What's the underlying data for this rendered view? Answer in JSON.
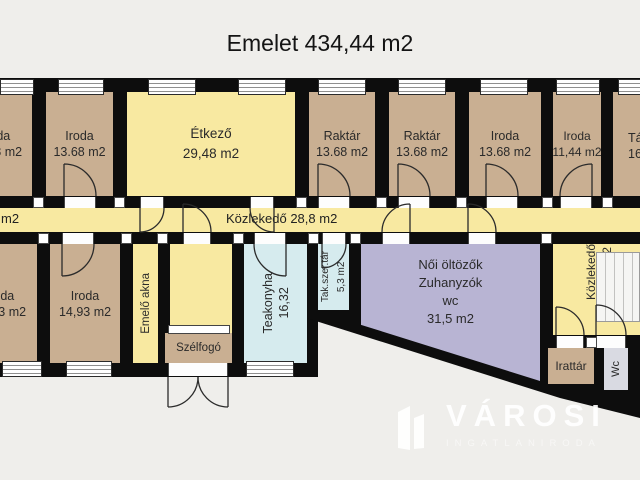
{
  "title": "Emelet 434,44 m2",
  "corridor": {
    "label": "Közlekedő 28,8 m2",
    "left_fragment": "m2"
  },
  "rooms": {
    "iroda_cut_top": {
      "name": "Iroda",
      "area": "13.68 m2"
    },
    "iroda2": {
      "name": "Iroda",
      "area": "13.68 m2"
    },
    "etkezo": {
      "name": "Étkező",
      "area": "29,48 m2"
    },
    "raktar1": {
      "name": "Raktár",
      "area": "13.68 m2"
    },
    "raktar2": {
      "name": "Raktár",
      "area": "13.68 m2"
    },
    "iroda3": {
      "name": "Iroda",
      "area": "13.68 m2"
    },
    "iroda4": {
      "name": "Iroda",
      "area": "11,44 m2"
    },
    "cut_right": {
      "name": "Tá",
      "area": "16"
    },
    "iroda_cut_bot": {
      "name": "Iroda",
      "area": "14,93 m2"
    },
    "iroda5": {
      "name": "Iroda",
      "area": "14,93 m2"
    },
    "emelo_akna": {
      "name": "Emelő akna"
    },
    "szelfogo": {
      "name": "Szélfogó"
    },
    "teakonyha": {
      "name": "Teakonyha",
      "area": "16,32"
    },
    "tak_szertar": {
      "name": "Tak.szer.tár",
      "area": "5,3 m2"
    },
    "noi_oltozok": {
      "name": "Női öltözők",
      "line2": "Zuhanyzók",
      "line3": "wc",
      "area": "31,5 m2"
    },
    "kozlekedo2": {
      "name": "Közlekedő",
      "area": "28,16 m2"
    },
    "irattar": {
      "name": "Irattár"
    },
    "wc": {
      "name": "Wc"
    }
  },
  "watermark": {
    "brand": "VÁROSI",
    "tagline": "INGATLANIRODA"
  },
  "colors": {
    "wall": "#0d0d0d",
    "room_tan": "#c9af92",
    "room_yellow": "#f8e9a1",
    "room_cyan": "#d6ebee",
    "room_purple": "#b8b4d3",
    "room_gray": "#d9dae2",
    "background": "#efeeeb"
  }
}
